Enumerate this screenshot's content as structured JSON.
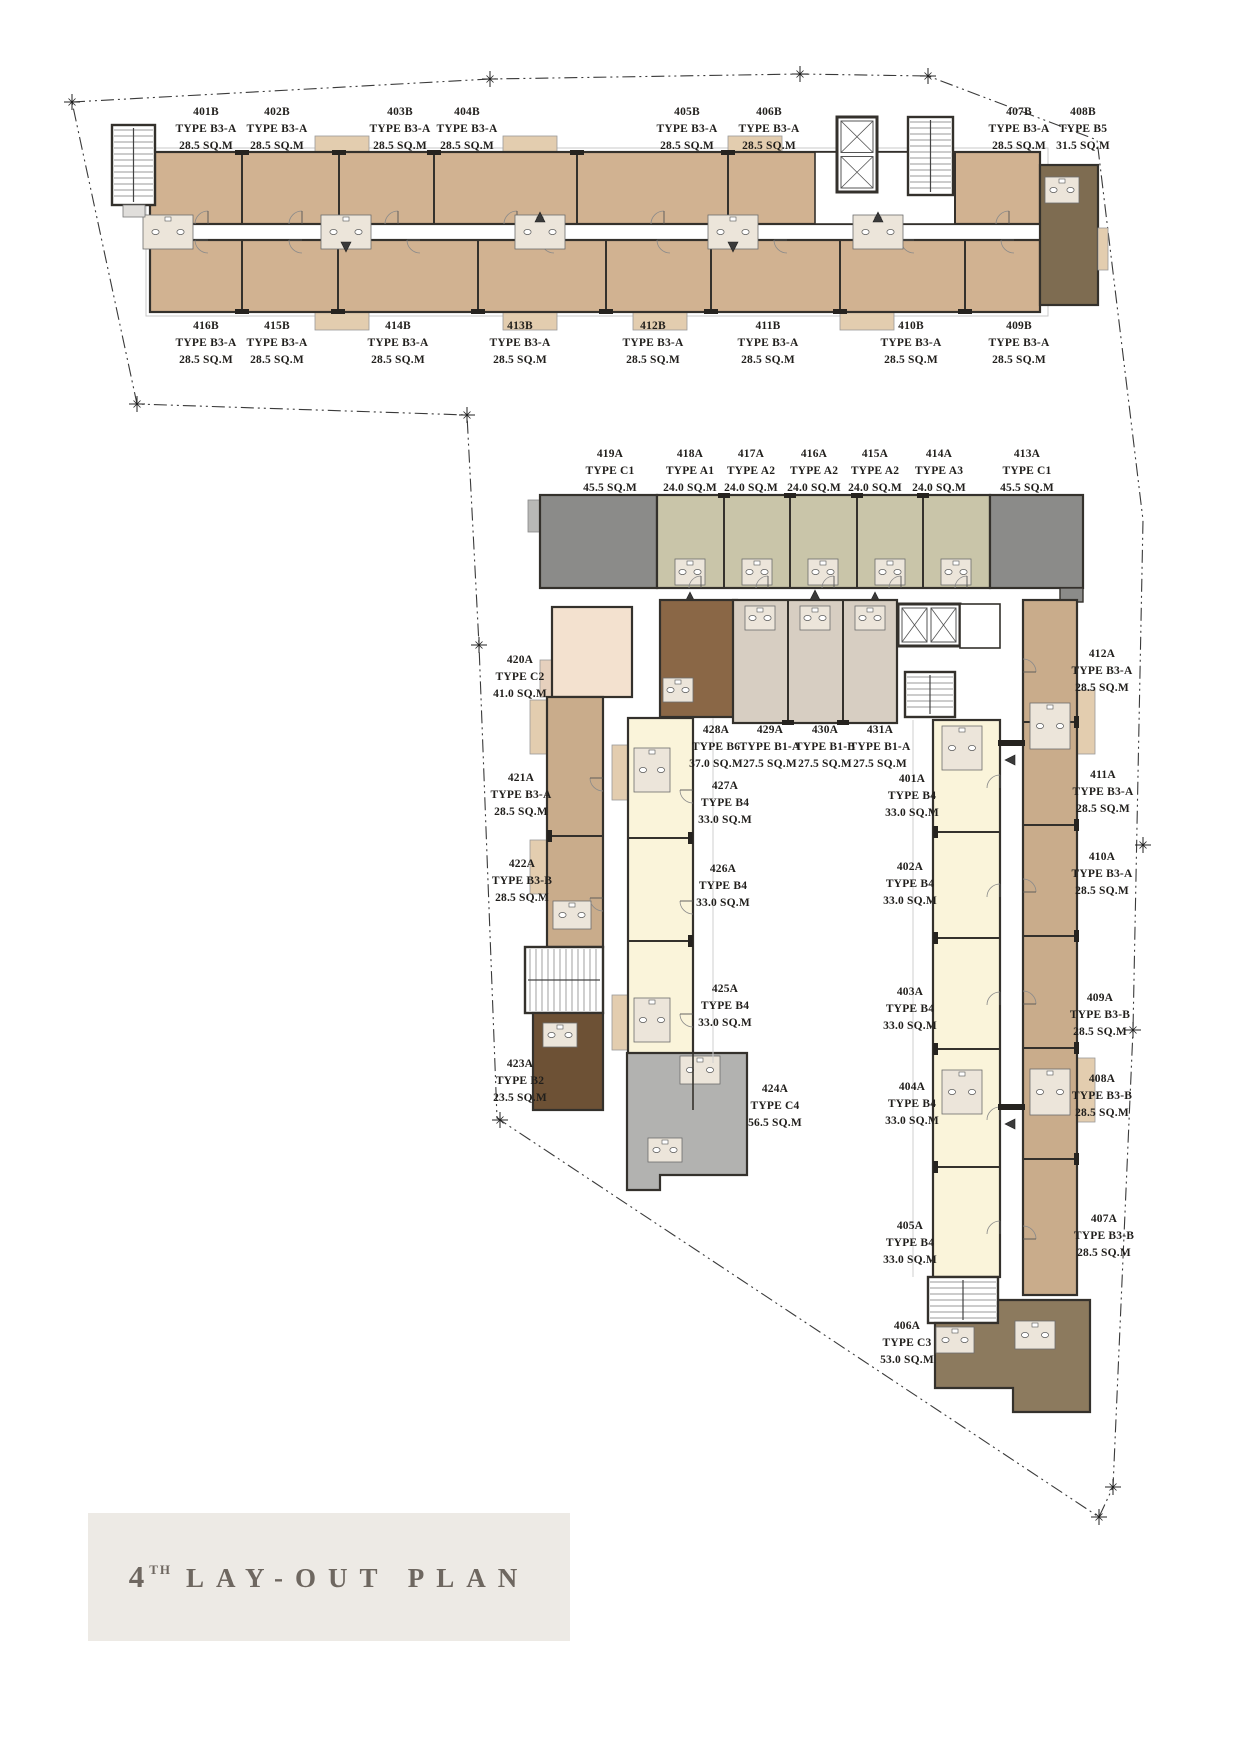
{
  "title": {
    "number": "4",
    "ordinal": "TH",
    "label": "LAY-OUT PLAN"
  },
  "colors": {
    "b3a_tan": "#d1b291",
    "b3_col_tan": "#c9ac8b",
    "b5_brown": "#7e6c51",
    "b6_brown": "#8a6746",
    "b2_brown": "#6d5135",
    "c3_brown": "#8c7a5e",
    "a_green": "#c9c5a9",
    "c1_gray": "#8b8b89",
    "c4_gray": "#b2b2b0",
    "c2_cream": "#f3e1cf",
    "b4_cream": "#faf4da",
    "b1_taupe": "#d7cec2",
    "wall": "#34312c",
    "balcony": "#e3cdaf",
    "boundary": "#3a3a3a",
    "fixture_bg": "#ece5da",
    "title_bg": "#edeae5",
    "title_text": "#6e6760",
    "label_text": "#211f1c"
  },
  "units": [
    {
      "no": "401B",
      "type": "TYPE B3-A",
      "area": "28.5 SQ.M"
    },
    {
      "no": "402B",
      "type": "TYPE B3-A",
      "area": "28.5 SQ.M"
    },
    {
      "no": "403B",
      "type": "TYPE B3-A",
      "area": "28.5 SQ.M"
    },
    {
      "no": "404B",
      "type": "TYPE B3-A",
      "area": "28.5 SQ.M"
    },
    {
      "no": "405B",
      "type": "TYPE B3-A",
      "area": "28.5 SQ.M"
    },
    {
      "no": "406B",
      "type": "TYPE B3-A",
      "area": "28.5 SQ.M"
    },
    {
      "no": "407B",
      "type": "TYPE B3-A",
      "area": "28.5 SQ.M"
    },
    {
      "no": "408B",
      "type": "TYPE B5",
      "area": "31.5 SQ.M"
    },
    {
      "no": "416B",
      "type": "TYPE B3-A",
      "area": "28.5 SQ.M"
    },
    {
      "no": "415B",
      "type": "TYPE B3-A",
      "area": "28.5 SQ.M"
    },
    {
      "no": "414B",
      "type": "TYPE B3-A",
      "area": "28.5 SQ.M"
    },
    {
      "no": "413B",
      "type": "TYPE B3-A",
      "area": "28.5 SQ.M"
    },
    {
      "no": "412B",
      "type": "TYPE B3-A",
      "area": "28.5 SQ.M"
    },
    {
      "no": "411B",
      "type": "TYPE B3-A",
      "area": "28.5 SQ.M"
    },
    {
      "no": "410B",
      "type": "TYPE B3-A",
      "area": "28.5 SQ.M"
    },
    {
      "no": "409B",
      "type": "TYPE B3-A",
      "area": "28.5 SQ.M"
    },
    {
      "no": "419A",
      "type": "TYPE C1",
      "area": "45.5 SQ.M"
    },
    {
      "no": "418A",
      "type": "TYPE A1",
      "area": "24.0 SQ.M"
    },
    {
      "no": "417A",
      "type": "TYPE A2",
      "area": "24.0 SQ.M"
    },
    {
      "no": "416A",
      "type": "TYPE A2",
      "area": "24.0 SQ.M"
    },
    {
      "no": "415A",
      "type": "TYPE A2",
      "area": "24.0 SQ.M"
    },
    {
      "no": "414A",
      "type": "TYPE A3",
      "area": "24.0 SQ.M"
    },
    {
      "no": "413A",
      "type": "TYPE C1",
      "area": "45.5 SQ.M"
    },
    {
      "no": "420A",
      "type": "TYPE C2",
      "area": "41.0 SQ.M"
    },
    {
      "no": "421A",
      "type": "TYPE B3-A",
      "area": "28.5 SQ.M"
    },
    {
      "no": "422A",
      "type": "TYPE B3-B",
      "area": "28.5 SQ.M"
    },
    {
      "no": "423A",
      "type": "TYPE B2",
      "area": "23.5 SQ.M"
    },
    {
      "no": "428A",
      "type": "TYPE B6",
      "area": "37.0 SQ.M"
    },
    {
      "no": "429A",
      "type": "TYPE B1-A",
      "area": "27.5 SQ.M"
    },
    {
      "no": "430A",
      "type": "TYPE B1-B",
      "area": "27.5 SQ.M"
    },
    {
      "no": "431A",
      "type": "TYPE B1-A",
      "area": "27.5 SQ.M"
    },
    {
      "no": "427A",
      "type": "TYPE B4",
      "area": "33.0 SQ.M"
    },
    {
      "no": "426A",
      "type": "TYPE B4",
      "area": "33.0 SQ.M"
    },
    {
      "no": "425A",
      "type": "TYPE B4",
      "area": "33.0 SQ.M"
    },
    {
      "no": "424A",
      "type": "TYPE C4",
      "area": "56.5 SQ.M"
    },
    {
      "no": "401A",
      "type": "TYPE B4",
      "area": "33.0 SQ.M"
    },
    {
      "no": "402A",
      "type": "TYPE B4",
      "area": "33.0 SQ.M"
    },
    {
      "no": "403A",
      "type": "TYPE B4",
      "area": "33.0 SQ.M"
    },
    {
      "no": "404A",
      "type": "TYPE B4",
      "area": "33.0 SQ.M"
    },
    {
      "no": "405A",
      "type": "TYPE B4",
      "area": "33.0 SQ.M"
    },
    {
      "no": "406A",
      "type": "TYPE C3",
      "area": "53.0 SQ.M"
    },
    {
      "no": "412A",
      "type": "TYPE B3-A",
      "area": "28.5 SQ.M"
    },
    {
      "no": "411A",
      "type": "TYPE B3-A",
      "area": "28.5 SQ.M"
    },
    {
      "no": "410A",
      "type": "TYPE B3-A",
      "area": "28.5 SQ.M"
    },
    {
      "no": "409A",
      "type": "TYPE B3-B",
      "area": "28.5 SQ.M"
    },
    {
      "no": "408A",
      "type": "TYPE B3-B",
      "area": "28.5 SQ.M"
    },
    {
      "no": "407A",
      "type": "TYPE B3-B",
      "area": "28.5 SQ.M"
    }
  ]
}
